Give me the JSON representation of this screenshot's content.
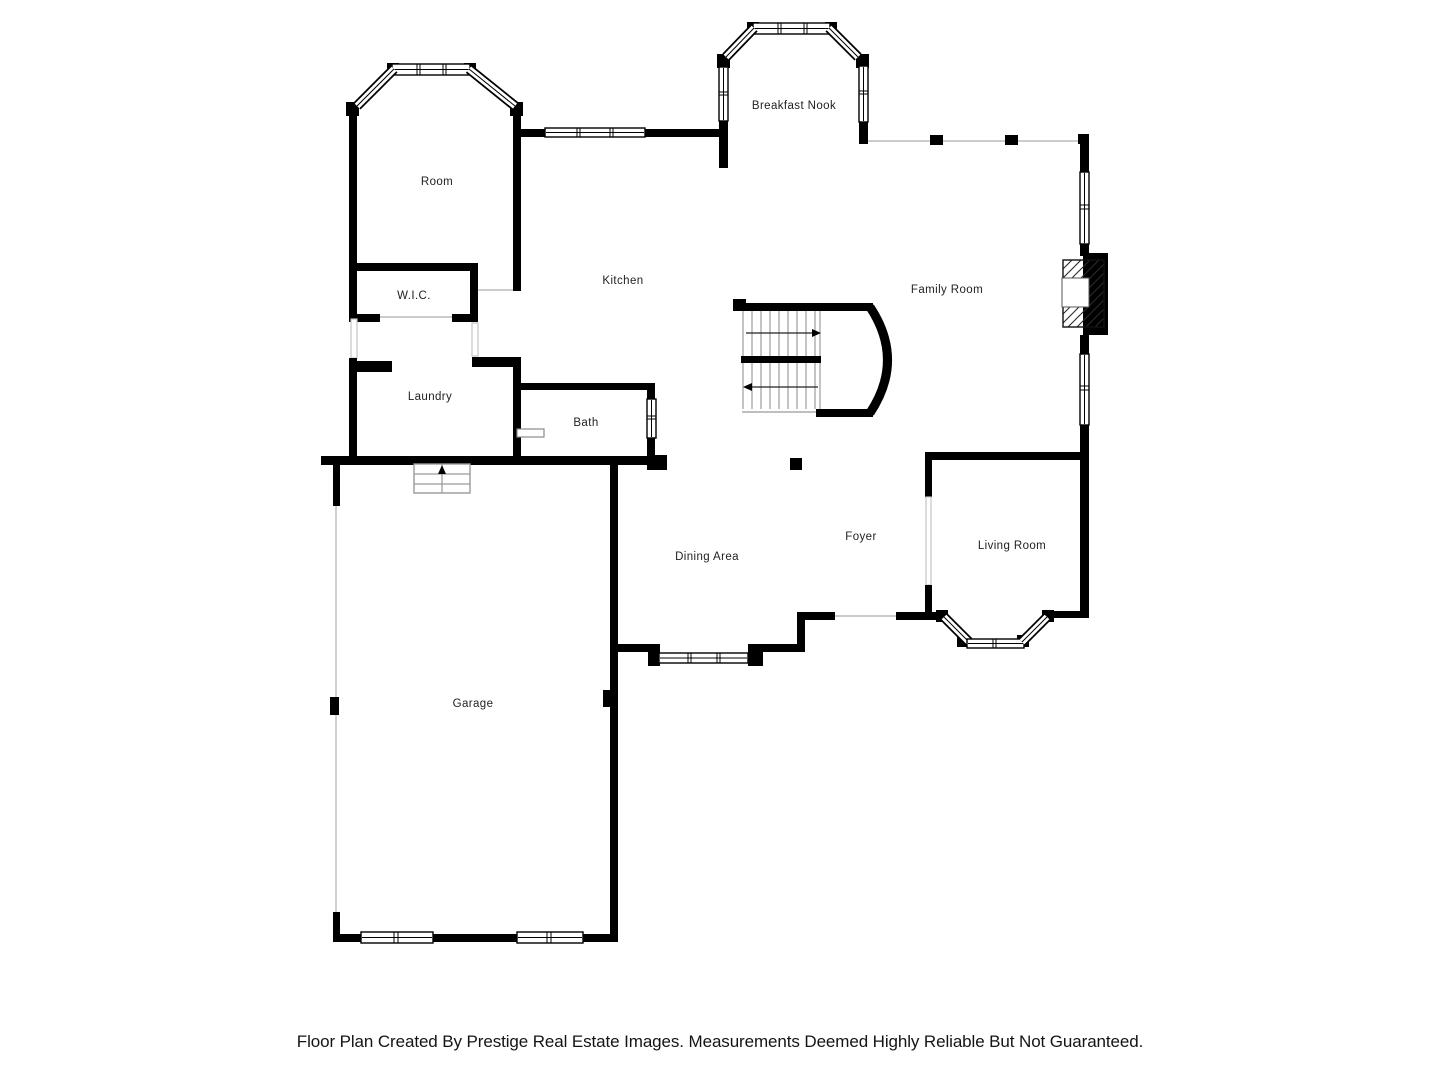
{
  "plan": {
    "wall_color": "#000000",
    "opening_line_color": "#bcbcbc",
    "label_color": "#1f1f1f",
    "rooms": [
      {
        "id": "breakfast-nook",
        "label": "Breakfast Nook"
      },
      {
        "id": "room",
        "label": "Room"
      },
      {
        "id": "kitchen",
        "label": "Kitchen"
      },
      {
        "id": "family-room",
        "label": "Family Room"
      },
      {
        "id": "wic",
        "label": "W.I.C."
      },
      {
        "id": "laundry",
        "label": "Laundry"
      },
      {
        "id": "bath",
        "label": "Bath"
      },
      {
        "id": "foyer",
        "label": "Foyer"
      },
      {
        "id": "dining-area",
        "label": "Dining Area"
      },
      {
        "id": "living-room",
        "label": "Living Room"
      },
      {
        "id": "garage",
        "label": "Garage"
      }
    ],
    "stairs": {
      "upper_flight_arrow": "right",
      "lower_flight_arrow": "left",
      "entry_steps_arrow": "up"
    },
    "features": [
      "fireplace",
      "bay-windows",
      "curved-stair-wall"
    ]
  },
  "footer": {
    "text": "Floor Plan Created By Prestige Real Estate Images. Measurements Deemed Highly Reliable But Not Guaranteed."
  }
}
